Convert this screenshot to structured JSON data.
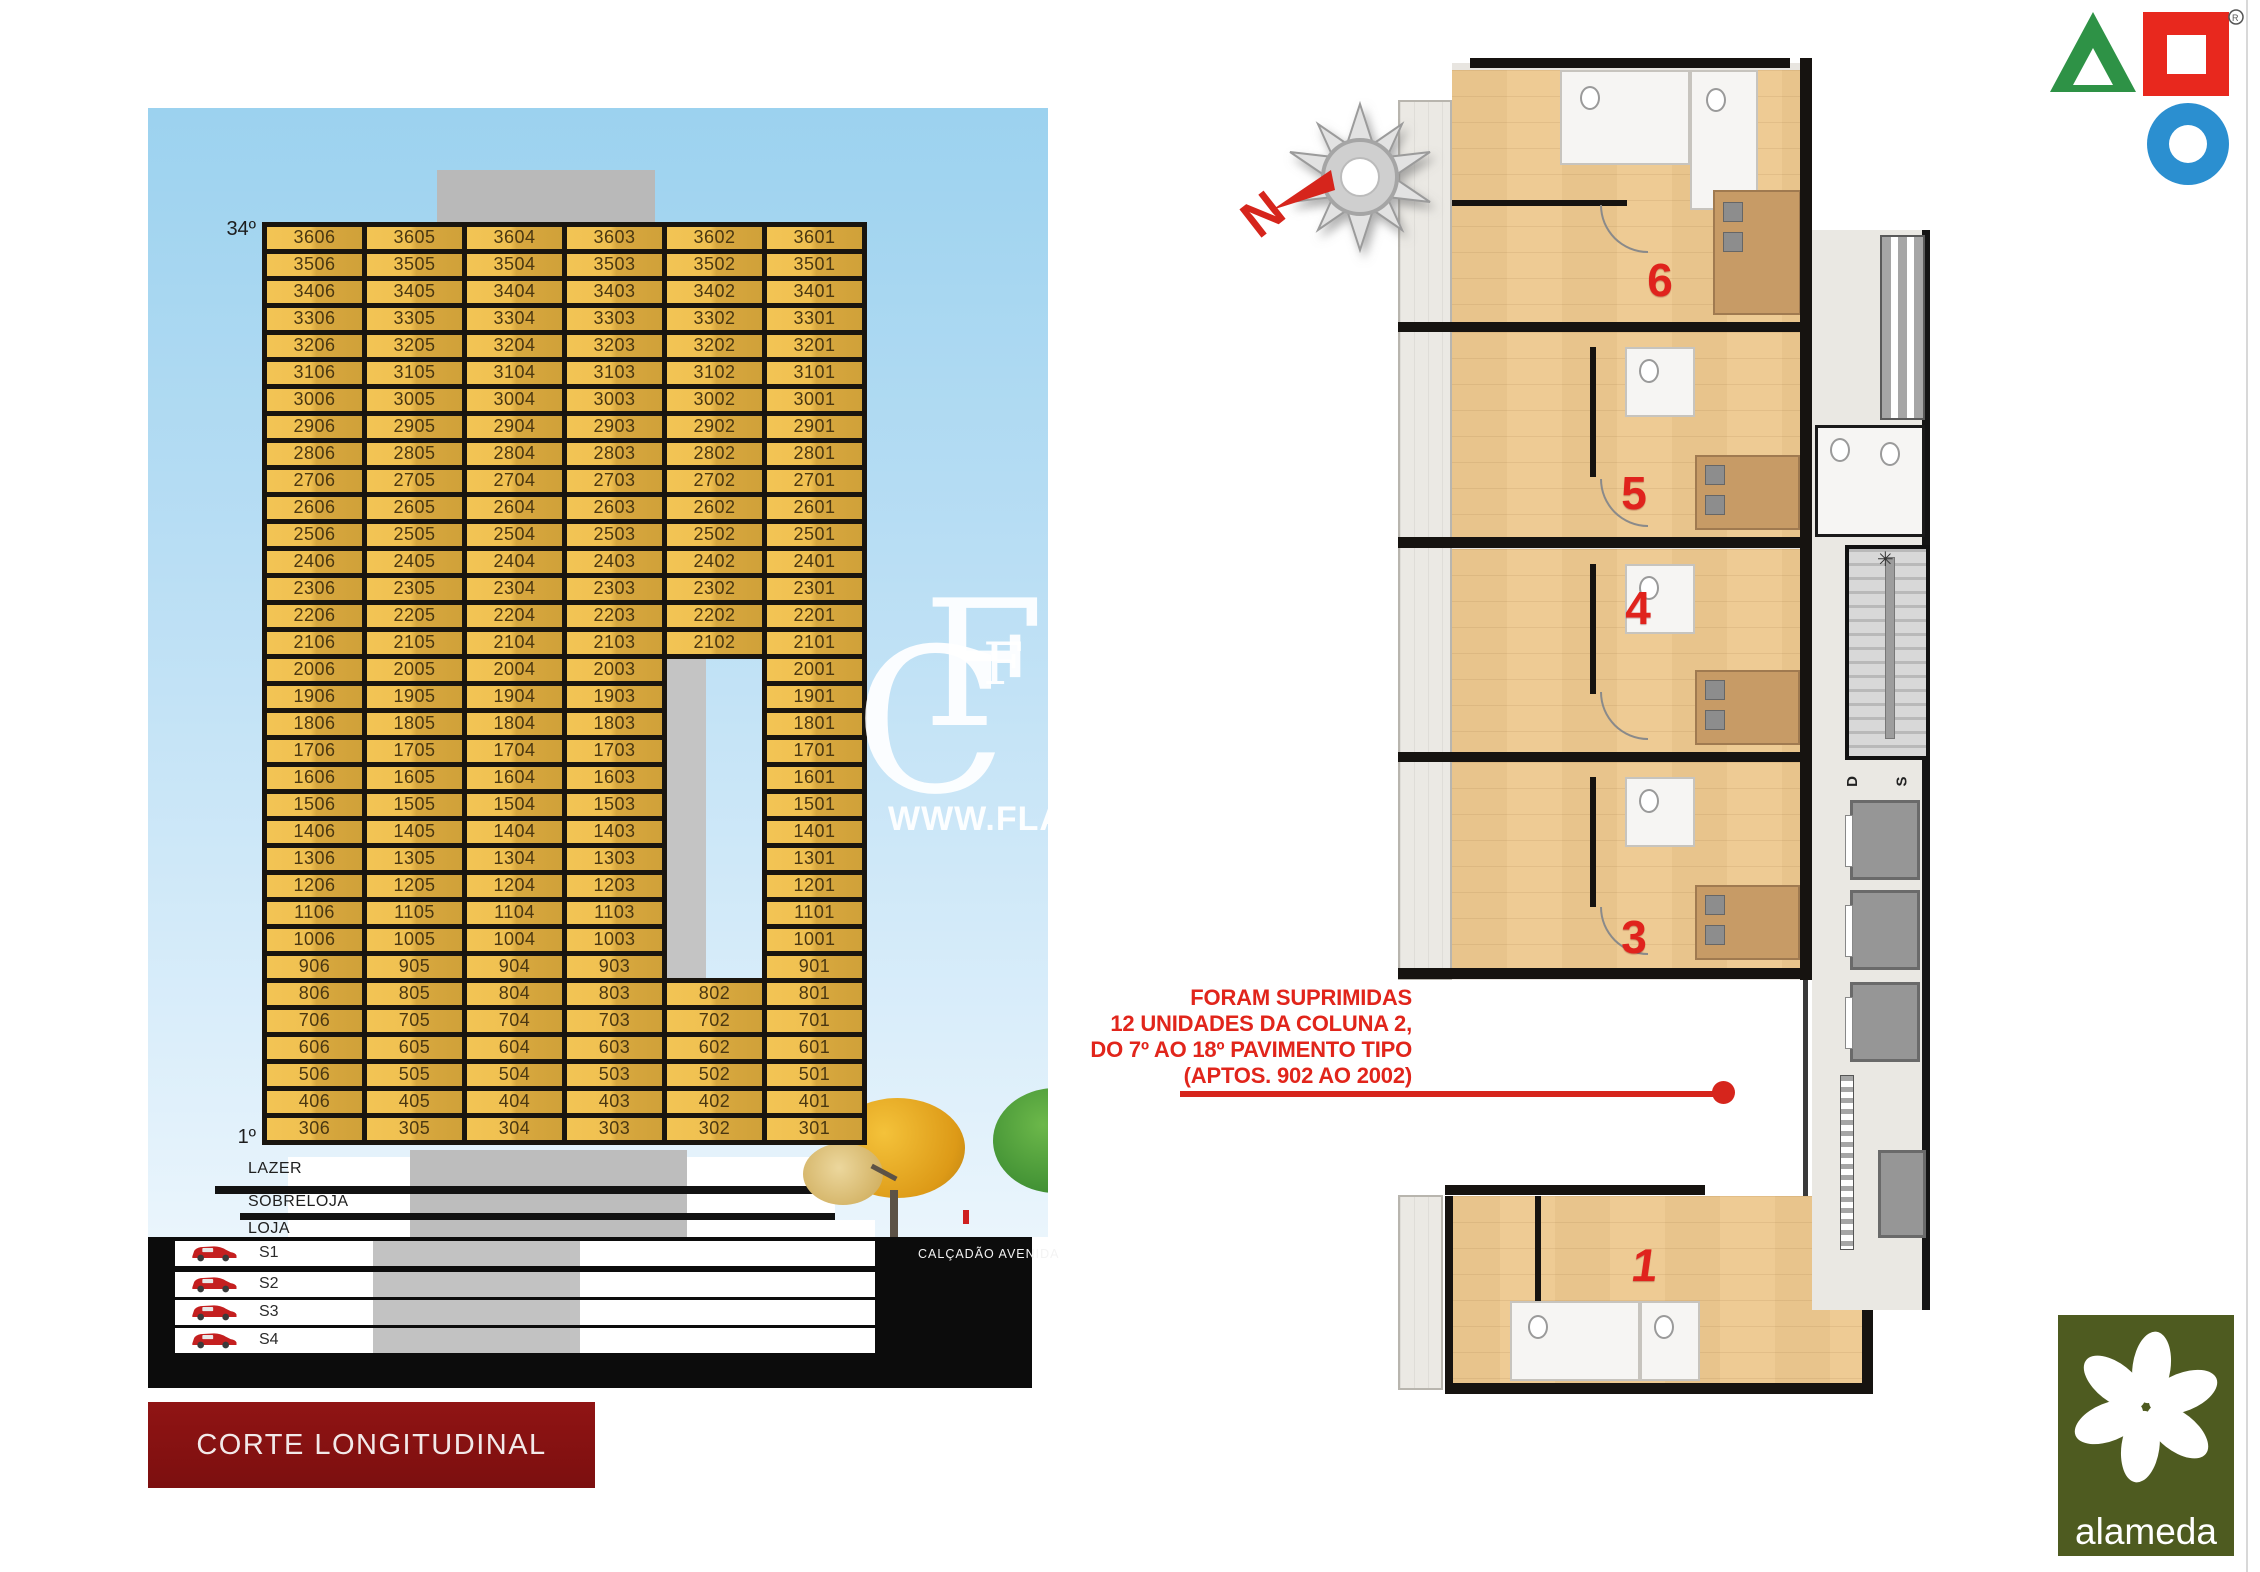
{
  "left_panel": {
    "top_floor_label": "34º",
    "bottom_floor_label": "1º",
    "tower_rows": [
      [
        "3606",
        "3605",
        "3604",
        "3603",
        "3602",
        "3601"
      ],
      [
        "3506",
        "3505",
        "3504",
        "3503",
        "3502",
        "3501"
      ],
      [
        "3406",
        "3405",
        "3404",
        "3403",
        "3402",
        "3401"
      ],
      [
        "3306",
        "3305",
        "3304",
        "3303",
        "3302",
        "3301"
      ],
      [
        "3206",
        "3205",
        "3204",
        "3203",
        "3202",
        "3201"
      ],
      [
        "3106",
        "3105",
        "3104",
        "3103",
        "3102",
        "3101"
      ],
      [
        "3006",
        "3005",
        "3004",
        "3003",
        "3002",
        "3001"
      ],
      [
        "2906",
        "2905",
        "2904",
        "2903",
        "2902",
        "2901"
      ],
      [
        "2806",
        "2805",
        "2804",
        "2803",
        "2802",
        "2801"
      ],
      [
        "2706",
        "2705",
        "2704",
        "2703",
        "2702",
        "2701"
      ],
      [
        "2606",
        "2605",
        "2604",
        "2603",
        "2602",
        "2601"
      ],
      [
        "2506",
        "2505",
        "2504",
        "2503",
        "2502",
        "2501"
      ],
      [
        "2406",
        "2405",
        "2404",
        "2403",
        "2402",
        "2401"
      ],
      [
        "2306",
        "2305",
        "2304",
        "2303",
        "2302",
        "2301"
      ],
      [
        "2206",
        "2205",
        "2204",
        "2203",
        "2202",
        "2201"
      ],
      [
        "2106",
        "2105",
        "2104",
        "2103",
        "2102",
        "2101"
      ],
      [
        "2006",
        "2005",
        "2004",
        "2003",
        null,
        "2001"
      ],
      [
        "1906",
        "1905",
        "1904",
        "1903",
        null,
        "1901"
      ],
      [
        "1806",
        "1805",
        "1804",
        "1803",
        null,
        "1801"
      ],
      [
        "1706",
        "1705",
        "1704",
        "1703",
        null,
        "1701"
      ],
      [
        "1606",
        "1605",
        "1604",
        "1603",
        null,
        "1601"
      ],
      [
        "1506",
        "1505",
        "1504",
        "1503",
        null,
        "1501"
      ],
      [
        "1406",
        "1405",
        "1404",
        "1403",
        null,
        "1401"
      ],
      [
        "1306",
        "1305",
        "1304",
        "1303",
        null,
        "1301"
      ],
      [
        "1206",
        "1205",
        "1204",
        "1203",
        null,
        "1201"
      ],
      [
        "1106",
        "1105",
        "1104",
        "1103",
        null,
        "1101"
      ],
      [
        "1006",
        "1005",
        "1004",
        "1003",
        null,
        "1001"
      ],
      [
        "906",
        "905",
        "904",
        "903",
        null,
        "901"
      ],
      [
        "806",
        "805",
        "804",
        "803",
        "802",
        "801"
      ],
      [
        "706",
        "705",
        "704",
        "703",
        "702",
        "701"
      ],
      [
        "606",
        "605",
        "604",
        "603",
        "602",
        "601"
      ],
      [
        "506",
        "505",
        "504",
        "503",
        "502",
        "501"
      ],
      [
        "406",
        "405",
        "404",
        "403",
        "402",
        "401"
      ],
      [
        "306",
        "305",
        "304",
        "303",
        "302",
        "301"
      ]
    ],
    "ground_floor_labels": [
      "LAZER",
      "SOBRELOJA",
      "LOJA"
    ],
    "basement_labels": [
      "S1",
      "S2",
      "S3",
      "S4"
    ],
    "street_label": "CALÇADÃO AVENIDA",
    "banner_title": "CORTE LONGITUDINAL"
  },
  "watermark": {
    "monogram_back": "C",
    "monogram_front": "F",
    "name": "FLA",
    "url": "WWW.FLAVIO"
  },
  "right_panel": {
    "north_letter": "N",
    "note_lines": [
      "FORAM SUPRIMIDAS",
      "12 UNIDADES DA COLUNA 2,",
      "DO 7º AO 18º PAVIMENTO TIPO",
      "(APTOS. 902 AO 2002)"
    ],
    "unit_numbers": [
      "6",
      "5",
      "4",
      "3",
      "1"
    ],
    "stair_labels": [
      "D",
      "S"
    ]
  },
  "brand": {
    "name": "alameda",
    "registered_mark": "®"
  },
  "colors": {
    "gold_cell": "#e9b84a",
    "red_accent": "#e0251c",
    "banner_red": "#8e1212",
    "sky_blue": "#a6d8f2",
    "alameda_green": "#4e5b20",
    "logo_green": "#2e9246",
    "logo_red": "#e8281e",
    "logo_blue": "#2b8fd0"
  }
}
